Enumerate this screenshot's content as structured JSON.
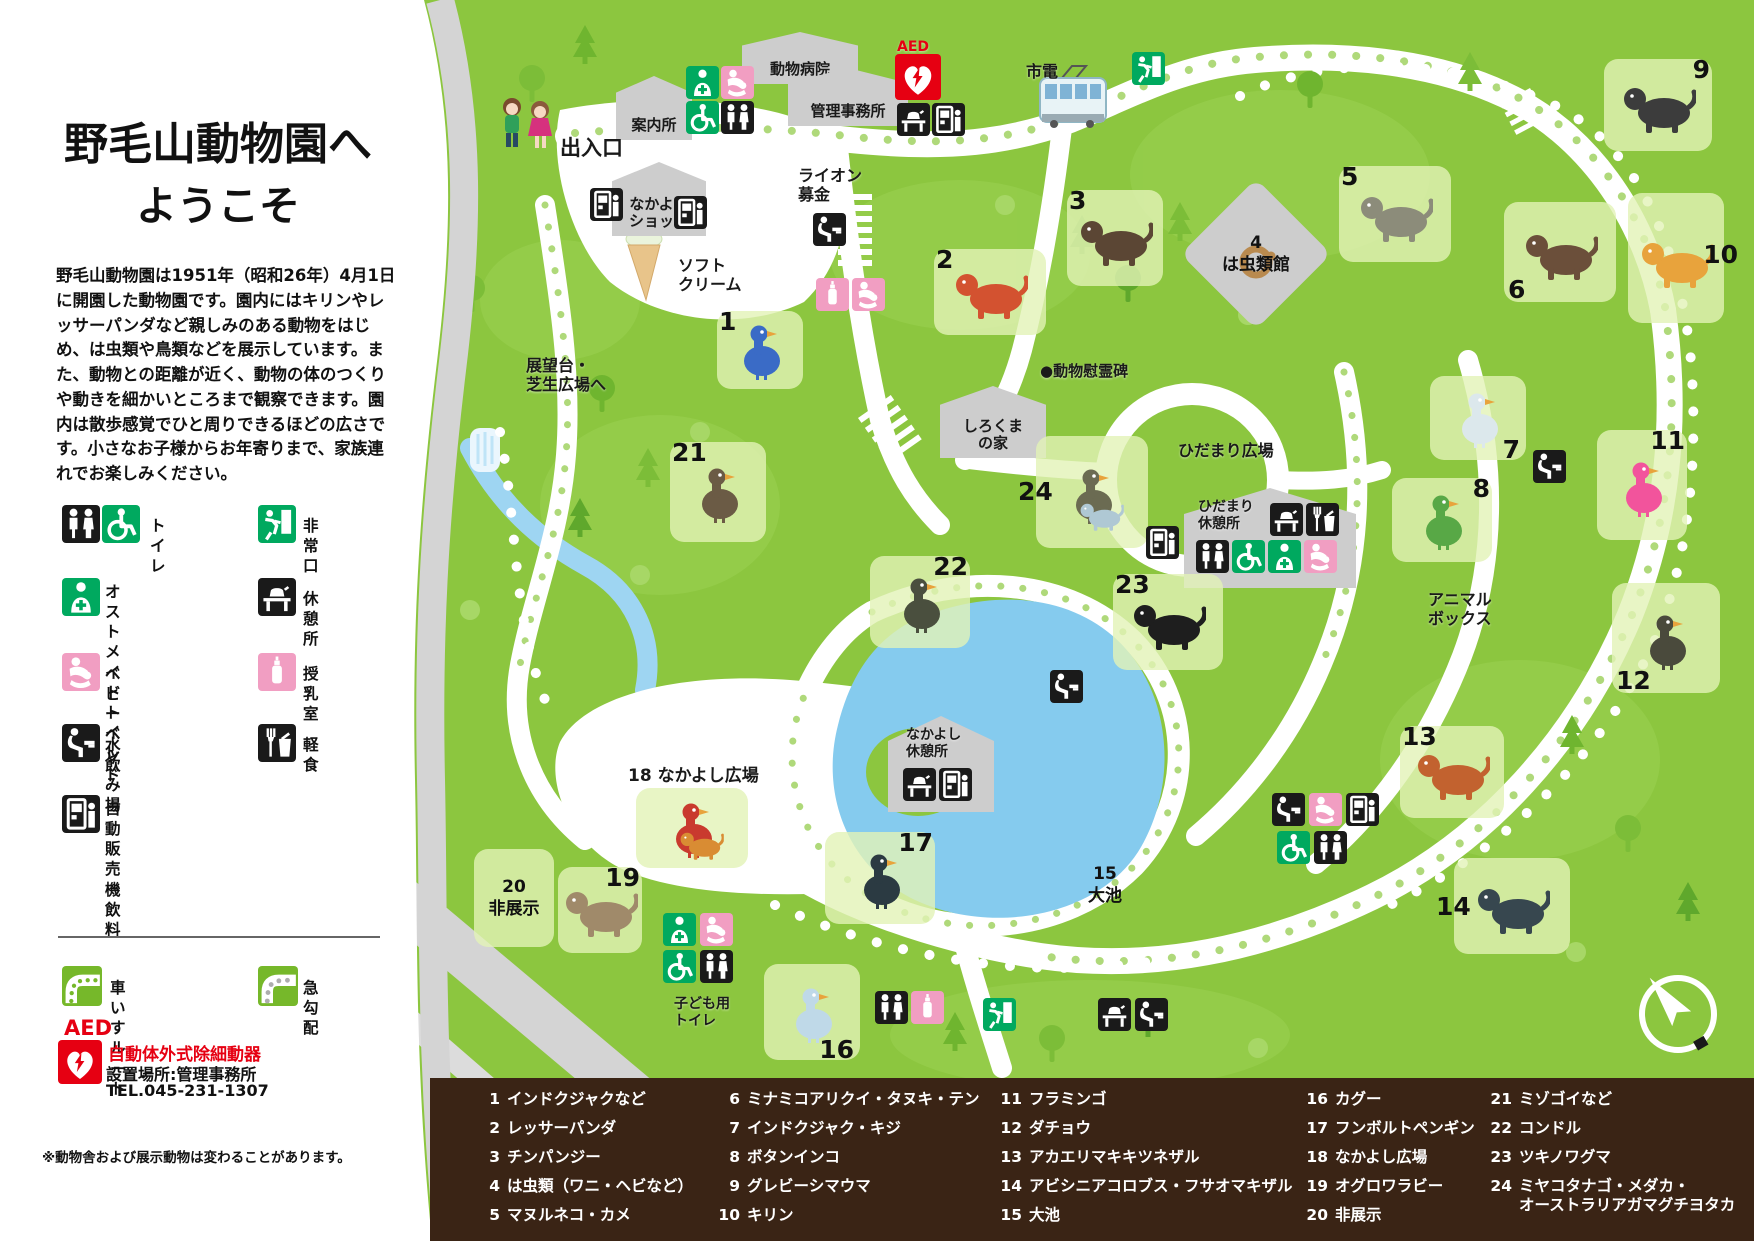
{
  "colors": {
    "map_green": "#8CC63F",
    "tree_green": "#6FB52F",
    "path_white": "#FFFFFF",
    "road_gray": "#D4D4D4",
    "pond_blue": "#85CBEE",
    "brown": "#3A2415",
    "icon_black": "#1A1A1A",
    "icon_green": "#00A95F",
    "icon_pink": "#F19EC2",
    "aed_red": "#E60012",
    "tile_green": "#CBE69A"
  },
  "panel": {
    "title_line1": "野毛山動物園へ",
    "title_line2": "ようこそ",
    "intro": "野毛山動物園は1951年（昭和26年）4月1日に開園した動物園です。園内にはキリンやレッサーパンダなど親しみのある動物をはじめ、は虫類や鳥類などを展示しています。また、動物との距離が近く、動物の体のつくりや動きを細かいところまで観察できます。園内は散歩感覚でひと周りできるほどの広さです。小さなお子様からお年寄りまで、家族連れでお楽しみください。",
    "legend": [
      {
        "icons": [
          "toilet",
          "wheelchair"
        ],
        "label": "トイレ",
        "x": 62,
        "y": 505,
        "lx": 150,
        "ly": 516
      },
      {
        "icons": [
          "exit"
        ],
        "label": "非常口",
        "x": 258,
        "y": 505,
        "lx": 303,
        "ly": 516
      },
      {
        "icons": [
          "ostomate"
        ],
        "label": "オストメイト\nトイレ",
        "x": 62,
        "y": 578,
        "lx": 105,
        "ly": 582
      },
      {
        "icons": [
          "rest"
        ],
        "label": "休憩所",
        "x": 258,
        "y": 578,
        "lx": 303,
        "ly": 589
      },
      {
        "icons": [
          "baby"
        ],
        "label": "ベビーベッド",
        "x": 62,
        "y": 653,
        "lx": 105,
        "ly": 664
      },
      {
        "icons": [
          "nursing"
        ],
        "label": "授乳室",
        "x": 258,
        "y": 653,
        "lx": 303,
        "ly": 664
      },
      {
        "icons": [
          "fountain"
        ],
        "label": "水飲み場",
        "x": 62,
        "y": 724,
        "lx": 105,
        "ly": 735
      },
      {
        "icons": [
          "meal"
        ],
        "label": "軽食",
        "x": 258,
        "y": 724,
        "lx": 303,
        "ly": 735
      },
      {
        "icons": [
          "vending"
        ],
        "label": "自動販売機\n飲料",
        "x": 62,
        "y": 795,
        "lx": 105,
        "ly": 799
      }
    ],
    "routes": [
      {
        "icon": "wheelchair-route",
        "label": "車いすルート",
        "x": 62,
        "y": 966,
        "lx": 110,
        "ly": 978
      },
      {
        "icon": "steep",
        "label": "急勾配",
        "x": 258,
        "y": 966,
        "lx": 303,
        "ly": 978
      }
    ],
    "aed": {
      "abbr": "AED",
      "name": "自動体外式除細動器",
      "location": "設置場所:管理事務所",
      "tel": "TEL.045-231-1307"
    },
    "note": "※動物舎および展示動物は変わることがあります。"
  },
  "map": {
    "labels": [
      {
        "text": "出入口",
        "x": 560,
        "y": 136,
        "size": 21
      },
      {
        "text": "市電",
        "x": 1026,
        "y": 62,
        "size": 16
      },
      {
        "text": "ソフト\nクリーム",
        "x": 678,
        "y": 256,
        "size": 16
      },
      {
        "text": "ライオン\n募金",
        "x": 798,
        "y": 166,
        "size": 16
      },
      {
        "text": "展望台・\n芝生広場へ",
        "x": 526,
        "y": 356,
        "size": 16
      },
      {
        "text": "●動物慰霊碑",
        "x": 1040,
        "y": 362,
        "size": 15
      },
      {
        "text": "ひだまり広場",
        "x": 1178,
        "y": 441,
        "size": 16
      },
      {
        "text": "ひだまり\n休憩所",
        "x": 1198,
        "y": 499,
        "size": 14
      },
      {
        "text": "アニマル\nボックス",
        "x": 1428,
        "y": 590,
        "size": 16
      },
      {
        "text": "なかよし\n休憩所",
        "x": 906,
        "y": 727,
        "size": 14
      },
      {
        "text": "子ども用\nトイレ",
        "x": 674,
        "y": 996,
        "size": 14
      },
      {
        "text": "18 なかよし広場",
        "x": 628,
        "y": 766,
        "size": 17
      },
      {
        "text": "AED",
        "x": 897,
        "y": 39,
        "size": 14,
        "color": "#E60012"
      }
    ],
    "buildings": [
      {
        "label": "案内所",
        "x": 616,
        "y": 76,
        "w": 76,
        "h": 64
      },
      {
        "label": "動物病院",
        "x": 742,
        "y": 32,
        "w": 116,
        "h": 52
      },
      {
        "label": "管理事務所",
        "x": 788,
        "y": 68,
        "w": 120,
        "h": 58
      },
      {
        "label": "なかよし\nショップ",
        "x": 612,
        "y": 162,
        "w": 94,
        "h": 74
      },
      {
        "label": "しろくま\nの家",
        "x": 940,
        "y": 386,
        "w": 106,
        "h": 72
      },
      {
        "label": "",
        "x": 1184,
        "y": 488,
        "w": 172,
        "h": 100
      },
      {
        "label": "",
        "x": 888,
        "y": 716,
        "w": 106,
        "h": 96
      }
    ],
    "exhibits": [
      {
        "num": "1",
        "name": "インドクジャクなど",
        "x": 760,
        "y": 350,
        "w": 86,
        "h": 78,
        "color": "#3A6BC6",
        "variant": "bird",
        "numpos": "tl"
      },
      {
        "num": "2",
        "name": "レッサーパンダ",
        "x": 990,
        "y": 292,
        "w": 112,
        "h": 86,
        "color": "#D35230",
        "variant": "quad",
        "numpos": "tl"
      },
      {
        "num": "3",
        "name": "チンパンジー",
        "x": 1115,
        "y": 238,
        "w": 96,
        "h": 96,
        "color": "#5B4634",
        "variant": "quad",
        "numpos": "tl"
      },
      {
        "num": "4",
        "name": "は虫類（ワニ・ヘビなど）",
        "x": 1256,
        "y": 254,
        "w": 130,
        "h": 130,
        "color": "#B98A4F",
        "variant": "coil",
        "shape": "diamond",
        "text": "4\nは虫類館"
      },
      {
        "num": "5",
        "name": "マヌルネコ・カメ",
        "x": 1395,
        "y": 214,
        "w": 112,
        "h": 96,
        "color": "#8C8C7A",
        "variant": "quad",
        "numpos": "tl"
      },
      {
        "num": "6",
        "name": "ミナミコアリクイ・タヌキ・テン",
        "x": 1560,
        "y": 252,
        "w": 112,
        "h": 100,
        "color": "#6B4F3A",
        "variant": "quad",
        "numpos": "bl"
      },
      {
        "num": "7",
        "name": "インドクジャク・キジ",
        "x": 1478,
        "y": 418,
        "w": 96,
        "h": 84,
        "color": "#DCE8EC",
        "variant": "bird",
        "numpos": "br"
      },
      {
        "num": "8",
        "name": "ボタンインコ",
        "x": 1442,
        "y": 520,
        "w": 100,
        "h": 84,
        "color": "#58A846",
        "variant": "bird",
        "numpos": "tr"
      },
      {
        "num": "9",
        "name": "グレビーシマウマ",
        "x": 1658,
        "y": 105,
        "w": 108,
        "h": 92,
        "color": "#3C3C3C",
        "variant": "quad",
        "numpos": "tr"
      },
      {
        "num": "10",
        "name": "キリン",
        "x": 1676,
        "y": 258,
        "w": 96,
        "h": 130,
        "color": "#E8A33C",
        "variant": "quad",
        "numpos": "r"
      },
      {
        "num": "11",
        "name": "フラミンゴ",
        "x": 1642,
        "y": 485,
        "w": 90,
        "h": 110,
        "color": "#F2549C",
        "variant": "bird",
        "numpos": "tr"
      },
      {
        "num": "12",
        "name": "ダチョウ",
        "x": 1666,
        "y": 638,
        "w": 108,
        "h": 110,
        "color": "#4A4A3C",
        "variant": "bird",
        "numpos": "bl"
      },
      {
        "num": "13",
        "name": "アカエリマキキツネザル",
        "x": 1452,
        "y": 772,
        "w": 104,
        "h": 92,
        "color": "#C2622F",
        "variant": "quad",
        "numpos": "tl"
      },
      {
        "num": "14",
        "name": "アビシニアコロブス・フサオマキザル",
        "x": 1512,
        "y": 906,
        "w": 116,
        "h": 96,
        "color": "#37474F",
        "variant": "quad",
        "numpos": "l"
      },
      {
        "num": "15",
        "name": "大池",
        "x": 1105,
        "y": 885,
        "w": 90,
        "h": 66,
        "shape": "none",
        "text": "15\n大池"
      },
      {
        "num": "16",
        "name": "カグー",
        "x": 812,
        "y": 1012,
        "w": 96,
        "h": 96,
        "color": "#BFD9E8",
        "variant": "bird",
        "numpos": "br"
      },
      {
        "num": "17",
        "name": "フンボルトペンギン",
        "x": 880,
        "y": 878,
        "w": 110,
        "h": 92,
        "color": "#2B3A42",
        "variant": "bird",
        "numpos": "tr"
      },
      {
        "num": "18",
        "name": "なかよし広場",
        "x": 692,
        "y": 828,
        "w": 112,
        "h": 80,
        "color": "#C93A2E",
        "color2": "#D98C33",
        "variant": "bird"
      },
      {
        "num": "19",
        "name": "オグロワラビー",
        "x": 600,
        "y": 910,
        "w": 84,
        "h": 86,
        "color": "#A08A6A",
        "variant": "quad",
        "numpos": "tr"
      },
      {
        "num": "20",
        "name": "非展示",
        "x": 514,
        "y": 898,
        "w": 80,
        "h": 98,
        "text": "20\n非展示"
      },
      {
        "num": "21",
        "name": "ミゾゴイなど",
        "x": 718,
        "y": 492,
        "w": 96,
        "h": 100,
        "color": "#6B5B45",
        "variant": "bird",
        "numpos": "tl"
      },
      {
        "num": "22",
        "name": "コンドル",
        "x": 920,
        "y": 602,
        "w": 100,
        "h": 92,
        "color": "#4A4F3E",
        "variant": "bird",
        "numpos": "tr"
      },
      {
        "num": "23",
        "name": "ツキノワグマ",
        "x": 1168,
        "y": 622,
        "w": 110,
        "h": 96,
        "color": "#1E1E1E",
        "variant": "quad",
        "numpos": "tl"
      },
      {
        "num": "24",
        "name": "ミヤコタナゴ・メダカ・オーストラリアガマグチヨタカ",
        "x": 1092,
        "y": 492,
        "w": 112,
        "h": 112,
        "color": "#6B6B52",
        "color2": "#AFC8D4",
        "variant": "bird",
        "numpos": "l"
      }
    ],
    "facilities": [
      {
        "type": "ostomate",
        "x": 686,
        "y": 66
      },
      {
        "type": "baby",
        "x": 721,
        "y": 66
      },
      {
        "type": "wheelchair",
        "x": 686,
        "y": 101
      },
      {
        "type": "toilet",
        "x": 721,
        "y": 101
      },
      {
        "type": "aed",
        "x": 895,
        "y": 54
      },
      {
        "type": "rest",
        "x": 897,
        "y": 103
      },
      {
        "type": "vending",
        "x": 932,
        "y": 103
      },
      {
        "type": "exit",
        "x": 1132,
        "y": 52
      },
      {
        "type": "vending",
        "x": 590,
        "y": 188
      },
      {
        "type": "vending",
        "x": 674,
        "y": 196
      },
      {
        "type": "fountain",
        "x": 813,
        "y": 213
      },
      {
        "type": "nursing",
        "x": 816,
        "y": 278
      },
      {
        "type": "baby",
        "x": 852,
        "y": 278
      },
      {
        "type": "vending",
        "x": 1146,
        "y": 526
      },
      {
        "type": "rest",
        "x": 1270,
        "y": 503
      },
      {
        "type": "meal",
        "x": 1306,
        "y": 503
      },
      {
        "type": "toilet",
        "x": 1196,
        "y": 540
      },
      {
        "type": "wheelchair",
        "x": 1232,
        "y": 540
      },
      {
        "type": "ostomate",
        "x": 1268,
        "y": 540
      },
      {
        "type": "baby",
        "x": 1304,
        "y": 540
      },
      {
        "type": "fountain",
        "x": 1050,
        "y": 670
      },
      {
        "type": "fountain",
        "x": 1533,
        "y": 450
      },
      {
        "type": "rest",
        "x": 903,
        "y": 768
      },
      {
        "type": "vending",
        "x": 939,
        "y": 768
      },
      {
        "type": "fountain",
        "x": 1272,
        "y": 793
      },
      {
        "type": "baby",
        "x": 1309,
        "y": 793
      },
      {
        "type": "vending",
        "x": 1346,
        "y": 793
      },
      {
        "type": "wheelchair",
        "x": 1277,
        "y": 831
      },
      {
        "type": "toilet",
        "x": 1314,
        "y": 831
      },
      {
        "type": "exit",
        "x": 983,
        "y": 998
      },
      {
        "type": "rest",
        "x": 1098,
        "y": 998
      },
      {
        "type": "fountain",
        "x": 1135,
        "y": 998
      },
      {
        "type": "ostomate",
        "x": 663,
        "y": 913
      },
      {
        "type": "baby",
        "x": 700,
        "y": 913
      },
      {
        "type": "wheelchair",
        "x": 663,
        "y": 950
      },
      {
        "type": "toilet",
        "x": 700,
        "y": 950
      },
      {
        "type": "toilet",
        "x": 875,
        "y": 991
      },
      {
        "type": "nursing",
        "x": 911,
        "y": 991
      }
    ]
  },
  "bottom_legend": {
    "columns": [
      {
        "x": 472,
        "items": [
          {
            "num": "1",
            "label": "インドクジャクなど"
          },
          {
            "num": "2",
            "label": "レッサーパンダ"
          },
          {
            "num": "3",
            "label": "チンパンジー"
          },
          {
            "num": "4",
            "label": "は虫類（ワニ・ヘビなど）"
          },
          {
            "num": "5",
            "label": "マヌルネコ・カメ"
          }
        ]
      },
      {
        "x": 712,
        "items": [
          {
            "num": "6",
            "label": "ミナミコアリクイ・タヌキ・テン"
          },
          {
            "num": "7",
            "label": "インドクジャク・キジ"
          },
          {
            "num": "8",
            "label": "ボタンインコ"
          },
          {
            "num": "9",
            "label": "グレビーシマウマ"
          },
          {
            "num": "10",
            "label": "キリン"
          }
        ]
      },
      {
        "x": 994,
        "items": [
          {
            "num": "11",
            "label": "フラミンゴ"
          },
          {
            "num": "12",
            "label": "ダチョウ"
          },
          {
            "num": "13",
            "label": "アカエリマキキツネザル"
          },
          {
            "num": "14",
            "label": "アビシニアコロブス・フサオマキザル"
          },
          {
            "num": "15",
            "label": "大池"
          }
        ]
      },
      {
        "x": 1300,
        "items": [
          {
            "num": "16",
            "label": "カグー"
          },
          {
            "num": "17",
            "label": "フンボルトペンギン"
          },
          {
            "num": "18",
            "label": "なかよし広場"
          },
          {
            "num": "19",
            "label": "オグロワラビー"
          },
          {
            "num": "20",
            "label": "非展示"
          }
        ]
      },
      {
        "x": 1484,
        "items": [
          {
            "num": "21",
            "label": "ミゾゴイなど"
          },
          {
            "num": "22",
            "label": "コンドル"
          },
          {
            "num": "23",
            "label": "ツキノワグマ"
          },
          {
            "num": "24",
            "label": "ミヤコタナゴ・メダカ・\nオーストラリアガマグチヨタカ"
          }
        ]
      }
    ]
  }
}
